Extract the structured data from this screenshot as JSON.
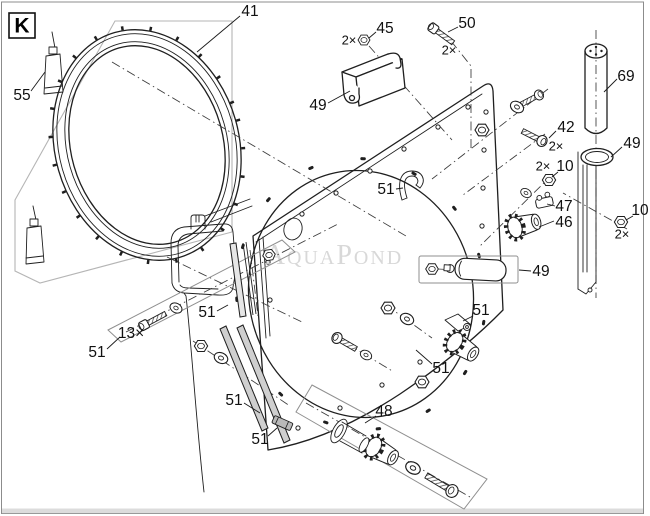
{
  "canvas": {
    "width": 650,
    "height": 516
  },
  "corner_tag": "K",
  "watermark": "AquaPond",
  "colors": {
    "line": "#1f1f1f",
    "region_outline": "#b5b5b5",
    "assembly_box": "#8f8f8f",
    "watermark": "#d2d2d2",
    "footer_bar": "#dcdcdc",
    "border": "#8c8c8c",
    "background": "#ffffff"
  },
  "callouts_summary": [
    {
      "part": "41"
    },
    {
      "part": "42",
      "qty": "2×"
    },
    {
      "part": "45",
      "qty": "2×"
    },
    {
      "part": "46"
    },
    {
      "part": "47"
    },
    {
      "part": "48"
    },
    {
      "part": "49"
    },
    {
      "part": "50",
      "qty": "2×"
    },
    {
      "part": "51"
    },
    {
      "part": "55"
    },
    {
      "part": "69"
    },
    {
      "part": "10",
      "qty": "2×"
    },
    {
      "part": "screw",
      "qty": "13×"
    }
  ],
  "labels": [
    {
      "text": "55",
      "x": 22,
      "y": 96,
      "leader": [
        31,
        91,
        45,
        72
      ]
    },
    {
      "text": "41",
      "x": 250,
      "y": 12,
      "leader": [
        240,
        16,
        197,
        52
      ]
    },
    {
      "text": "2×",
      "x": 349,
      "y": 41,
      "small": true
    },
    {
      "text": "45",
      "x": 385,
      "y": 29,
      "leader": [
        376,
        32,
        369,
        38
      ]
    },
    {
      "text": "50",
      "x": 467,
      "y": 24,
      "leader": [
        458,
        27,
        448,
        32
      ]
    },
    {
      "text": "2×",
      "x": 449,
      "y": 51,
      "small": true
    },
    {
      "text": "69",
      "x": 626,
      "y": 77,
      "leader": [
        617,
        79,
        604,
        92
      ]
    },
    {
      "text": "49",
      "x": 318,
      "y": 106,
      "leader": [
        328,
        103,
        350,
        91
      ]
    },
    {
      "text": "42",
      "x": 566,
      "y": 128,
      "leader": [
        556,
        131,
        549,
        138
      ]
    },
    {
      "text": "2×",
      "x": 556,
      "y": 147,
      "small": true
    },
    {
      "text": "49",
      "x": 632,
      "y": 144,
      "leader": [
        622,
        147,
        611,
        157
      ]
    },
    {
      "text": "2×",
      "x": 543,
      "y": 167,
      "small": true
    },
    {
      "text": "10",
      "x": 565,
      "y": 167,
      "leader": [
        558,
        172,
        552,
        177
      ]
    },
    {
      "text": "47",
      "x": 564,
      "y": 207,
      "leader": [
        555,
        206,
        547,
        204
      ]
    },
    {
      "text": "46",
      "x": 564,
      "y": 223,
      "leader": [
        554,
        221,
        539,
        227
      ]
    },
    {
      "text": "10",
      "x": 640,
      "y": 211,
      "leader": [
        633,
        216,
        626,
        220
      ]
    },
    {
      "text": "2×",
      "x": 622,
      "y": 235,
      "small": true
    },
    {
      "text": "51",
      "x": 386,
      "y": 190,
      "leader": [
        396,
        189,
        403,
        188
      ]
    },
    {
      "text": "49",
      "x": 541,
      "y": 272,
      "leader": [
        531,
        271,
        519,
        270
      ]
    },
    {
      "text": "51",
      "x": 481,
      "y": 311,
      "leader": [
        473,
        316,
        463,
        321
      ]
    },
    {
      "text": "51",
      "x": 441,
      "y": 369,
      "leader": [
        432,
        364,
        416,
        350
      ]
    },
    {
      "text": "48",
      "x": 384,
      "y": 412,
      "leader": [
        376,
        416,
        365,
        423
      ]
    },
    {
      "text": "51",
      "x": 207,
      "y": 313,
      "leader": [
        217,
        311,
        228,
        305
      ]
    },
    {
      "text": "51",
      "x": 97,
      "y": 353,
      "leader": [
        107,
        349,
        120,
        337
      ]
    },
    {
      "text": "13×",
      "x": 131,
      "y": 334
    },
    {
      "text": "51",
      "x": 234,
      "y": 401,
      "leader": [
        244,
        403,
        260,
        413
      ]
    },
    {
      "text": "51",
      "x": 260,
      "y": 440,
      "leader": [
        268,
        436,
        277,
        428
      ]
    }
  ]
}
